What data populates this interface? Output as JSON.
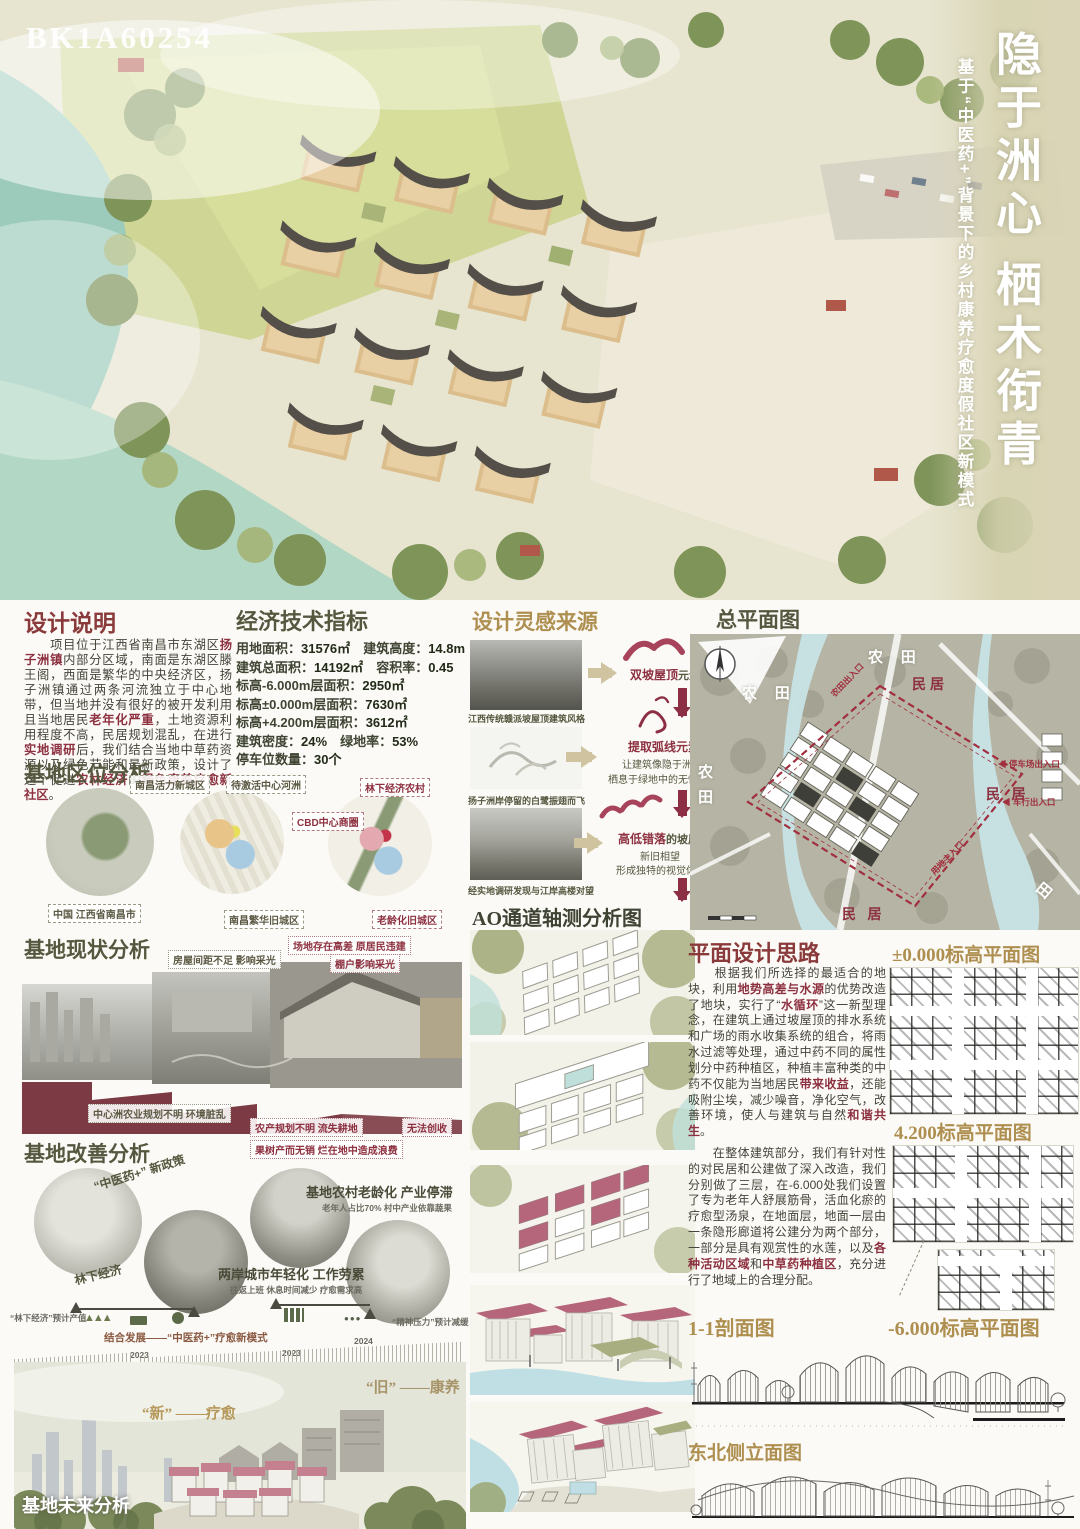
{
  "palette": {
    "maroon": "#8d3040",
    "olive": "#55583f",
    "gold": "#ae8f50"
  },
  "hero": {
    "code": "BK1A60254",
    "title_main": "隐于洲心  栖木衔青",
    "title_sub": "基于“中医药+”背景下的乡村康养疗愈度假社区新模式"
  },
  "design_note": {
    "heading": "设计说明",
    "segments": [
      {
        "t": "　　项目位于江西省南昌市东湖区",
        "b": false
      },
      {
        "t": "扬子洲镇",
        "b": true
      },
      {
        "t": "内部分区域，南面是东湖区滕王阁，西面是繁华的中央经济区，扬子洲镇通过两条河流独立于中心地带，但当地并没有很好的被开发利用且当地居民",
        "b": false
      },
      {
        "t": "老年化严重",
        "b": true
      },
      {
        "t": "，土地资源利用程度不高，民居规划混乱，在进行",
        "b": false
      },
      {
        "t": "实地调研",
        "b": true
      },
      {
        "t": "后，我们结合当地中草药资源以及绿色节能和最新政策，设计了这个促进",
        "b": false
      },
      {
        "t": "农林经济",
        "b": true
      },
      {
        "t": "的",
        "b": false
      },
      {
        "t": "绿色康养疗愈新社区",
        "b": true
      },
      {
        "t": "。",
        "b": false
      }
    ]
  },
  "eco": {
    "heading": "经济技术指标",
    "rows": [
      [
        {
          "label": "用地面积：",
          "value": "31576㎡"
        },
        {
          "label": "建筑高度：",
          "value": "14.8m"
        }
      ],
      [
        {
          "label": "建筑总面积：",
          "value": "14192㎡"
        },
        {
          "label": "容积率：",
          "value": "0.45"
        }
      ],
      [
        {
          "label": "标高-6.000m层面积：",
          "value": "2950㎡"
        }
      ],
      [
        {
          "label": "标高±0.000m层面积：",
          "value": "7630㎡"
        }
      ],
      [
        {
          "label": "标高+4.200m层面积：",
          "value": "3612㎡"
        }
      ],
      [
        {
          "label": "建筑密度：",
          "value": "24%"
        },
        {
          "label": "绿地率：",
          "value": "53%"
        }
      ],
      [
        {
          "label": "停车位数量：",
          "value": "30个"
        }
      ]
    ]
  },
  "inspiration": {
    "heading": "设计灵感来源",
    "caption1": "江西传统赣派坡屋顶建筑风格",
    "caption2": "扬子洲岸停留的白鹭振翅而飞",
    "caption3": "经实地调研发现与江岸高楼对望",
    "result1_bold": "双坡屋顶",
    "result1_rest": "元素",
    "result2_bold": "提取弧线元素",
    "result2_line1": "让建筑像隐于洲心",
    "result2_line2": "栖息于绿地中的无忧白鹭",
    "result3_bold": "高低错落",
    "result3_rest": "的坡屋顶",
    "result3_line1": "新旧相望",
    "result3_line2": "形成独特的视觉体验"
  },
  "location": {
    "heading": "基地区位分析",
    "map1_bottom": "中国 江西省南昌市",
    "map2_top_left": "南昌活力新城区",
    "map2_top_right": "待激活中心河洲",
    "map2_bottom": "南昌繁华旧城区",
    "map3_top": "林下经济农村",
    "map3_left": "CBD中心商圈",
    "map3_bottom": "老龄化旧城区"
  },
  "status": {
    "heading": "基地现状分析",
    "l1": "房屋间距不足 影响采光",
    "l2": "场地存在高差 原居民违建",
    "l3": "棚户影响采光",
    "l4": "中心洲农业规划不明 环境脏乱",
    "l5": "农产规划不明 流失耕地",
    "l6": "无法创收",
    "l7": "果树产而无销 烂在地中造成浪费"
  },
  "improve": {
    "heading": "基地改善分析",
    "policy": "“中医药+” 新政策",
    "aging": "基地农村老龄化 产业停滞",
    "aging_sub": "老年人占比70% 村中产业依靠蔬果",
    "forest": "林下经济",
    "young": "两岸城市年轻化 工作劳累",
    "young_sub": "往返上班 休息时间减少 疗愈需求高",
    "output": "“林下经济”预计产值",
    "combine": "结合发展——“中医药+”疗愈新模式",
    "relief": "“精神压力”预计减缓",
    "y1": "2023",
    "y2": "2023",
    "y3": "2024"
  },
  "future": {
    "heading": "基地未来分析",
    "new_label": "“新” ——疗愈",
    "old_label": "“旧” ——康养"
  },
  "masterplan": {
    "heading": "总平面图",
    "farm_tr": "农 田",
    "farm_tl": "农 田",
    "farm_left": "农田",
    "farm_br": "田",
    "res1": "民居",
    "res2": "民 居",
    "res3": "民 居",
    "e1": "农田出入口",
    "e2": "◀ 停车场出入口",
    "e3": "◀ 车行出入口",
    "e4": "用地主入口"
  },
  "axon": {
    "heading": "AO通道轴测分析图"
  },
  "plan_design": {
    "heading": "平面设计思路",
    "p1": [
      {
        "t": "　　根据我们所选择的最适合的地块，利用",
        "b": false
      },
      {
        "t": "地势高差与水源",
        "b": true
      },
      {
        "t": "的优势改造了地块，实行了“",
        "b": false
      },
      {
        "t": "水循环",
        "b": true
      },
      {
        "t": "”这一新型理念，在建筑上通过坡屋顶的排水系统和广场的雨水收集系统的组合，将雨水过滤等处理，通过中药不同的属性划分中药种植区，种植丰富种类的中药不仅能为当地居民",
        "b": false
      },
      {
        "t": "带来收益",
        "b": true
      },
      {
        "t": "，还能吸附尘埃，减少噪音，净化空气，改善环境，使人与建筑与自然",
        "b": false
      },
      {
        "t": "和谐共生",
        "b": true
      },
      {
        "t": "。",
        "b": false
      }
    ],
    "p2": [
      {
        "t": "　　在整体建筑部分，我们有针对性的对民居和公建做了深入改造，我们分别做了三层，在-6.000处我们设置了专为老年人舒展筋骨，活血化瘀的疗愈型汤泉，在地面层，地面一层由一条隐形廊道将公建分为两个部分，一部分是具有观赏性的水莲，以及",
        "b": false
      },
      {
        "t": "各种活动区域",
        "b": true
      },
      {
        "t": "和",
        "b": false
      },
      {
        "t": "中草药种植区",
        "b": true
      },
      {
        "t": "，充分进行了地域上的合理分配。",
        "b": false
      }
    ]
  },
  "plans": {
    "h000": "±0.000标高平面图",
    "h420": "4.200标高平面图",
    "h600": "-6.000标高平面图",
    "section": "1-1剖面图",
    "elev": "东北侧立面图"
  }
}
